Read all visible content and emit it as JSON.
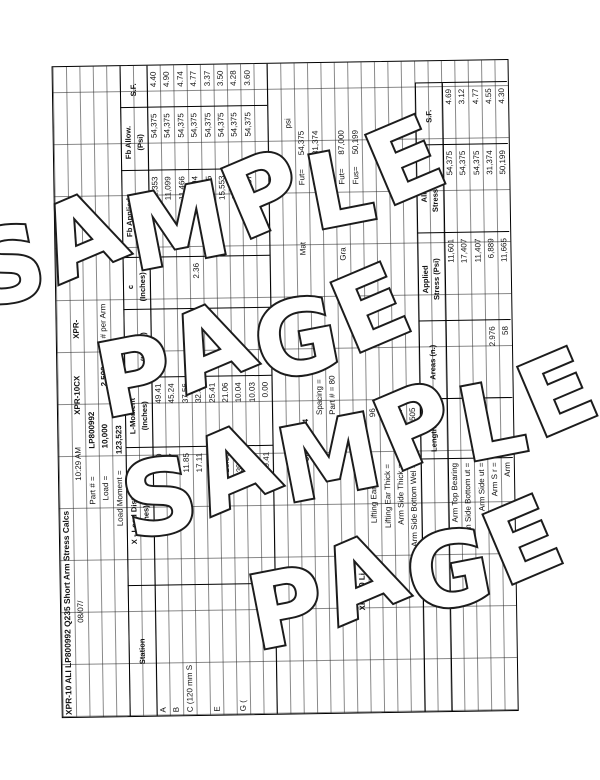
{
  "watermark": {
    "line1": "SAMPLE",
    "line2": "PAGE"
  },
  "sheet": {
    "title": "XPR-10 ALI LP800992 Q235 Short Arm Stress Calcs",
    "model_a": "XPR-10CX",
    "model_b": "XPR-",
    "date": "08/07/",
    "time": "10:29 AM",
    "part_label": "Part # =",
    "part_value": "LP800992",
    "load_label": "Load =",
    "load_value": "10,000",
    "per_arm_value": "2,500",
    "per_arm_label": "# per Arm",
    "moment_label": "Load Moment =",
    "moment_value": "123,523",
    "stress_table": {
      "headers": {
        "station": "Station",
        "x1": "X - Load Dist.",
        "x2": "(Inches)",
        "lm1": "L-Moment",
        "lm2": "(Inches)",
        "ixx1": "Ixx",
        "ixx2": "(Inches)",
        "c1": "c",
        "c2": "(Inches)",
        "fba1": "Fb Applied",
        "fba2": "(Psi)",
        "fbl1": "Fb Allow.",
        "fbl2": "(Psi)",
        "sf": "S.F."
      },
      "rows": [
        {
          "station": "A",
          "x": "0.00",
          "lm": "49.41",
          "ixx": "",
          "c": "",
          "fb_applied": "12,353",
          "fb_allow": "54,375",
          "sf": "4.40"
        },
        {
          "station": "B",
          "x": "4.17",
          "lm": "45.24",
          "ixx": "",
          "c": "",
          "fb_applied": "11,099",
          "fb_allow": "54,375",
          "sf": "4.90"
        },
        {
          "station": "C (120 mm S",
          "x": "11.85",
          "lm": "37.56",
          "ixx": "",
          "c": "",
          "fb_applied": "11,466",
          "fb_allow": "54,375",
          "sf": "4.74"
        },
        {
          "station": "",
          "x": "17.11",
          "lm": "32.30",
          "ixx": "",
          "c": "2.36",
          "fb_applied": "11,394",
          "fb_allow": "54,375",
          "sf": "4.77"
        },
        {
          "station": "E",
          "x": "24.00",
          "lm": "25.41",
          "ixx": "63.54",
          "c": "",
          "fb_applied": "16,125",
          "fb_allow": "54,375",
          "sf": "3.37"
        },
        {
          "station": "",
          "x": "28.35",
          "lm": "21.06",
          "ixx": "",
          "c": "",
          "fb_applied": "15,553",
          "fb_allow": "54,375",
          "sf": "3.50"
        },
        {
          "station": "G (",
          "x": "39.37",
          "lm": "10.04",
          "ixx": "",
          "c": "",
          "fb_applied": "12,710",
          "fb_allow": "54,375",
          "sf": "4.28"
        },
        {
          "station": "",
          "x": "39.38",
          "lm": "10.03",
          "ixx": "",
          "c": "",
          "fb_applied": "15,087",
          "fb_allow": "54,375",
          "sf": "3.60"
        },
        {
          "station": "",
          "x": "49.41",
          "lm": "0.00",
          "ixx": "",
          "c": "",
          "fb_applied": "",
          "fb_allow": "",
          "sf": ""
        }
      ]
    },
    "material": {
      "psi": "psi",
      "mat_label": "Mat",
      "grade_label": "Gra",
      "fut_label": "Fut=",
      "fus_label": "Fus=",
      "fut1": "54,375",
      "fus1": "31,374",
      "fut2": "87,000",
      "fus2": "50,199"
    },
    "section2": {
      "title": "XPR-10 Li",
      "spacing_label": "Spacing =",
      "spacing_value": "02",
      "part_label": "Part # = 80",
      "part_value": "800986/184",
      "dim_rows": [
        {
          "label": "Lifting Ear Wid =",
          "value": "96"
        },
        {
          "label": "Lifting Ear Thick =",
          "value": "79"
        },
        {
          "label": "Arm Side  Thick =",
          "value": "7"
        },
        {
          "label": "Arm Side Bottom Wel =",
          "value": "0.505"
        }
      ],
      "headers": {
        "len": "Length (in.)",
        "area": "Areas (n.)",
        "app1": "Applied",
        "app2": "Stress (Psi)",
        "alw1": "Allow.",
        "alw2": "Stress (Psi)",
        "sf": "S.F."
      },
      "rows": [
        {
          "label": "Arm Top Bearing",
          "area": "",
          "applied": "11,601",
          "allow": "54,375",
          "sf": "4.69"
        },
        {
          "label": "Arm Side Bottom ut =",
          "area": "",
          "applied": "17,407",
          "allow": "54,375",
          "sf": "3.12"
        },
        {
          "label": "Arm Side ut =",
          "area": "",
          "applied": "11,407",
          "allow": "54,375",
          "sf": "4.77"
        },
        {
          "label": "Arm S r =",
          "area": "2.976",
          "applied": "6,889",
          "allow": "31,374",
          "sf": "4.55"
        },
        {
          "label": "Arm",
          "area": "58",
          "applied": "11,665",
          "allow": "50,199",
          "sf": "4.30"
        }
      ]
    }
  }
}
